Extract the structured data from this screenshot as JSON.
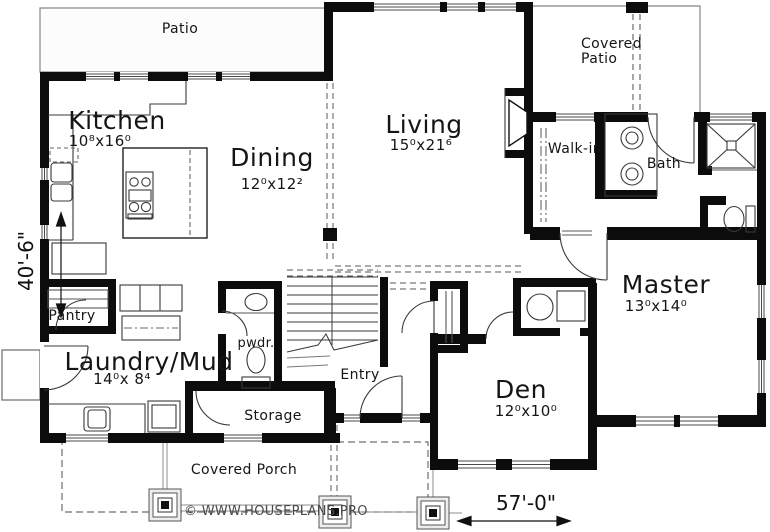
{
  "rooms": {
    "patio": {
      "label": "Patio"
    },
    "covered_patio": {
      "label_line1": "Covered",
      "label_line2": "Patio"
    },
    "kitchen": {
      "label": "Kitchen",
      "dims": "10⁸x16⁰"
    },
    "dining": {
      "label": "Dining",
      "dims": "12⁰x12²"
    },
    "living": {
      "label": "Living",
      "dims": "15⁰x21⁶"
    },
    "walk_in": {
      "label": "Walk-in"
    },
    "bath": {
      "label": "Bath"
    },
    "master": {
      "label": "Master",
      "dims": "13⁰x14⁰"
    },
    "pantry": {
      "label": "Pantry"
    },
    "laundry": {
      "label": "Laundry/Mud",
      "dims": "14⁰x 8⁴"
    },
    "powder": {
      "label": "pwdr."
    },
    "entry": {
      "label": "Entry"
    },
    "storage": {
      "label": "Storage"
    },
    "den": {
      "label": "Den",
      "dims": "12⁰x10⁰"
    },
    "covered_porch": {
      "label": "Covered Porch"
    }
  },
  "dimensions": {
    "overall_width": "57'-0\"",
    "overall_height": "40'-6\""
  },
  "watermark": {
    "text": "© WWW.HOUSEPLANS.PRO"
  },
  "colors": {
    "wall": "#0c0c0c",
    "line": "#3a3a3a",
    "light_line": "#8c8c8c",
    "background": "#ffffff"
  }
}
